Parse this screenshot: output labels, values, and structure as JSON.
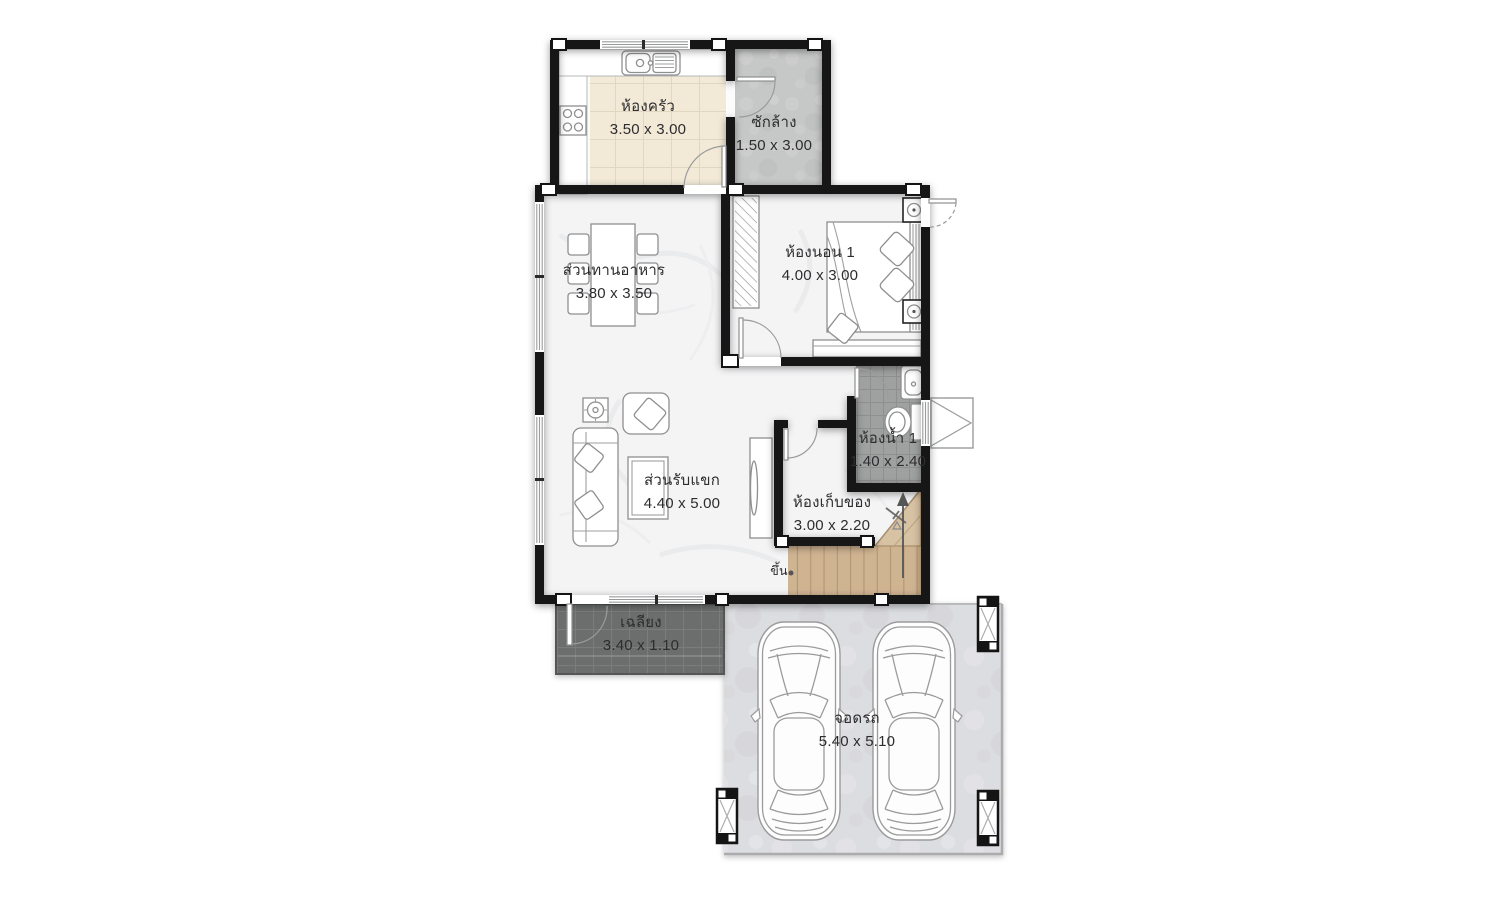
{
  "plan": {
    "rooms": {
      "kitchen": {
        "name": "ห้องครัว",
        "dims": "3.50 x 3.00"
      },
      "laundry": {
        "name": "ซักล้าง",
        "dims": "1.50 x 3.00"
      },
      "dining": {
        "name": "ส่วนทานอาหาร",
        "dims": "3.80 x 3.50"
      },
      "bedroom1": {
        "name": "ห้องนอน 1",
        "dims": "4.00 x 3.00"
      },
      "bathroom1": {
        "name": "ห้องน้ำ 1",
        "dims": "1.40 x 2.40"
      },
      "living": {
        "name": "ส่วนรับแขก",
        "dims": "4.40 x 5.00"
      },
      "storage": {
        "name": "ห้องเก็บของ",
        "dims": "3.00 x 2.20"
      },
      "porch": {
        "name": "เฉลียง",
        "dims": "3.40 x 1.10"
      },
      "garage": {
        "name": "จอดรถ",
        "dims": "5.40 x 5.10"
      }
    },
    "annotations": {
      "stairs_up": "ขึ้น"
    }
  },
  "colors": {
    "wall": "#141414",
    "marble_floor": "#f4f4f5",
    "kitchen_tile": "#f2e9d7",
    "laundry_concrete": "#c6c7c7",
    "bathroom_tile": "#9fa0a0",
    "porch_tile": "#6c6d6d",
    "garage_concrete": "#dcdde0",
    "stair_wood": "#cfb492",
    "label_text": "#2d2d2f"
  }
}
